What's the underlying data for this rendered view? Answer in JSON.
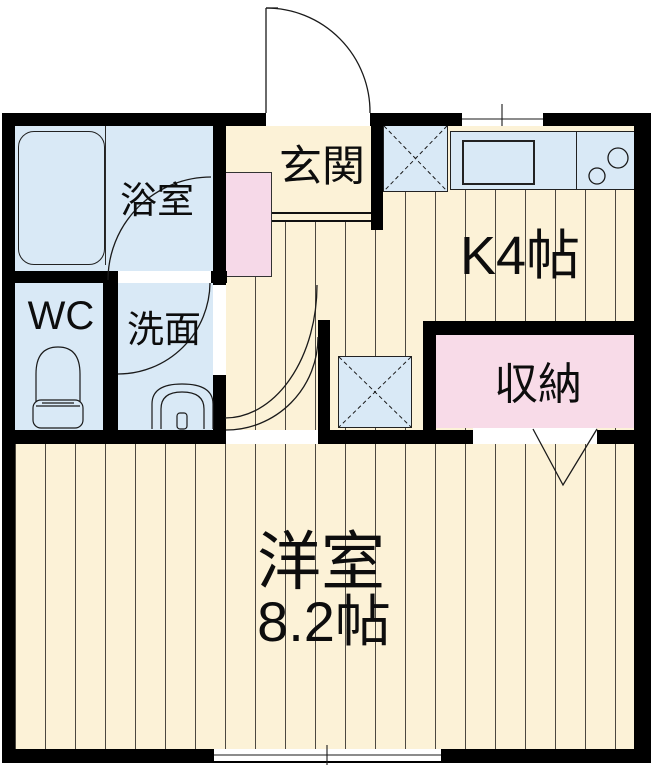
{
  "rooms": {
    "bathroom": {
      "label": "浴室"
    },
    "wc": {
      "label": "WC"
    },
    "washroom": {
      "label": "洗面"
    },
    "entrance": {
      "label": "玄関"
    },
    "kitchen": {
      "label": "K4帖"
    },
    "closet": {
      "label": "収納"
    },
    "main_room": {
      "label": "洋室",
      "size": "8.2帖"
    }
  },
  "fixtures": [
    "bathtub",
    "toilet",
    "washbasin",
    "shoe-cabinet",
    "kitchen-counter",
    "kitchen-sink",
    "stove-burners",
    "refrigerator-space",
    "washer-space",
    "entrance-door",
    "bath-door",
    "washroom-door",
    "main-room-door",
    "closet-door",
    "kitchen-window",
    "main-room-window"
  ],
  "colors": {
    "floor": "#fcf2d7",
    "wet_area": "#d9e9f6",
    "closet_fill": "#f8dbe8",
    "cabinet_fill": "#f6d9e8",
    "wall": "#000000",
    "line": "#1a1a1a"
  }
}
